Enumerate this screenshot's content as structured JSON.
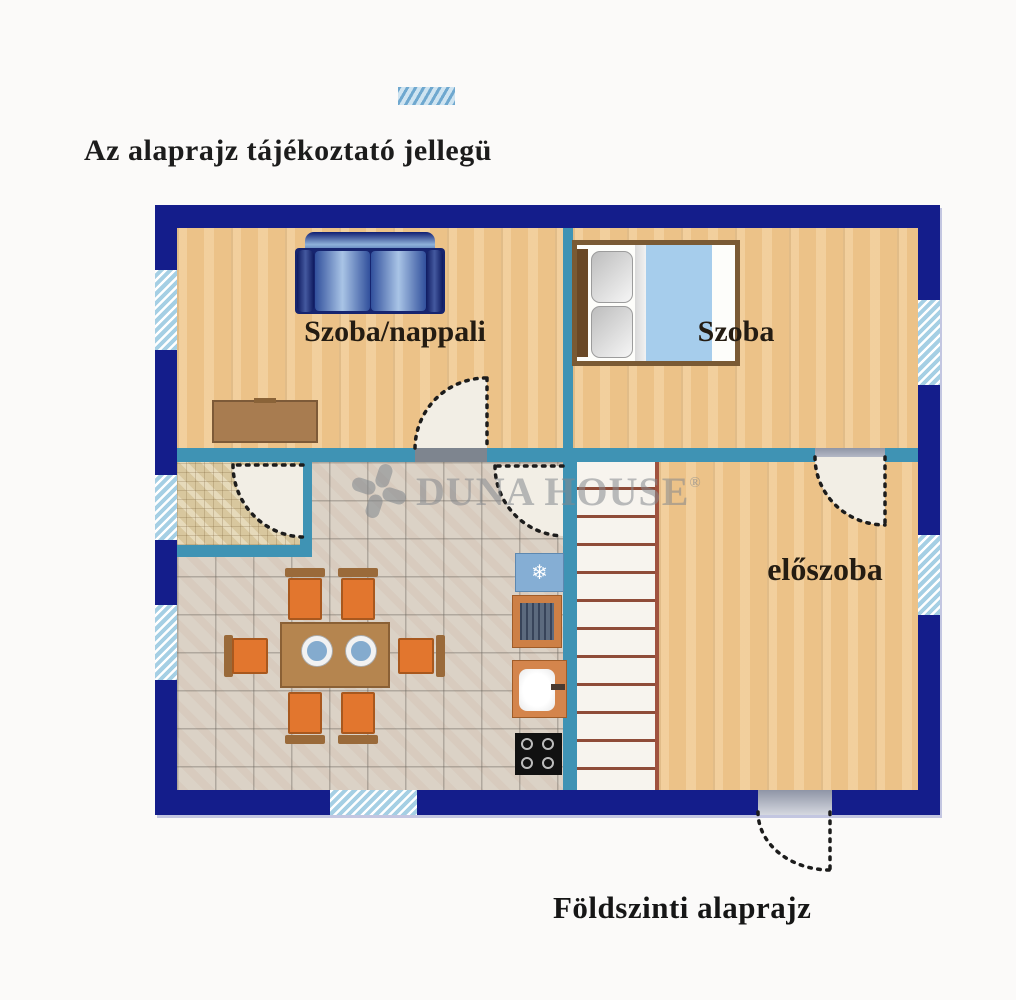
{
  "texts": {
    "disclaimer": "Az alaprajz tájékoztató jellegü",
    "caption": "Földszinti alaprajz"
  },
  "rooms": {
    "living": {
      "label": "Szoba/nappali"
    },
    "bedroom": {
      "label": "Szoba"
    },
    "hall": {
      "label": "előszoba"
    },
    "bathroom": {
      "label": ""
    },
    "kitchen": {
      "label": ""
    }
  },
  "watermark": {
    "brand": "DUNA HOUSE",
    "registered": "®"
  },
  "icons": {
    "snowflake": "❄"
  },
  "colors": {
    "outer_wall_navy": "#141d8b",
    "partition_teal": "#3f93b4",
    "wood_floor": "#ecc288",
    "kitchen_tile": "#dbd2c6",
    "bathroom_mosaic": "#d8c79e",
    "window_hatch_blue": "#a5cfe4",
    "stair_line_red": "#8f4c38",
    "sofa_blue": "#31509c",
    "chair_orange": "#e2762e",
    "fridge_blue": "#85aed4",
    "blanket_blue": "#a6cdec",
    "watermark_gray": "#85898e"
  }
}
